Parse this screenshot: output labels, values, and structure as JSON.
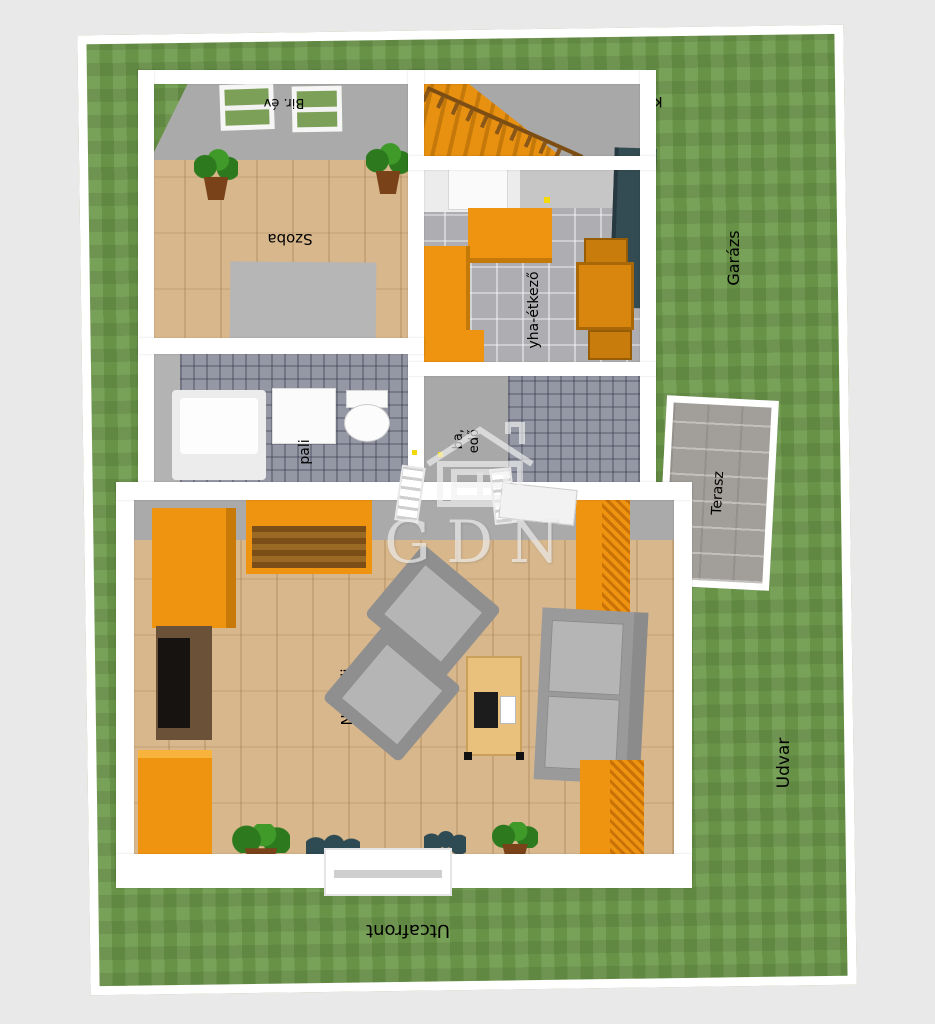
{
  "watermark": {
    "text": "GDN",
    "icon": "gdn-house-logo"
  },
  "outdoor": {
    "garden_fragment": "Ke",
    "garage": "Garázs",
    "yard": "Udvar",
    "street_front": "Utcafront"
  },
  "rooms": {
    "bedroom": "Szoba",
    "kitchen_dining_fragment": "yha-étkező",
    "living_room": "Nappali",
    "terrace": "Terasz",
    "bathroom_fragment": "pali",
    "hall_fragment_line1": "ba,",
    "hall_fragment_line2": "edő",
    "window_fragment": "Bir. év"
  },
  "colors": {
    "background": "#e9e9e9",
    "lawn": "#6e9a4c",
    "wall": "#ffffff",
    "wall_inner_face": "#aaaaaa",
    "wood_floor": "#d8b78c",
    "kitchen_tile": "#b7b7bb",
    "bathroom_tile": "#8e929e",
    "terrace_tile": "#a8a49f",
    "furniture_orange": "#ef9410",
    "furniture_gray": "#9b9b9b",
    "wardrobe_teal": "#334b52",
    "label_text": "#000000"
  }
}
